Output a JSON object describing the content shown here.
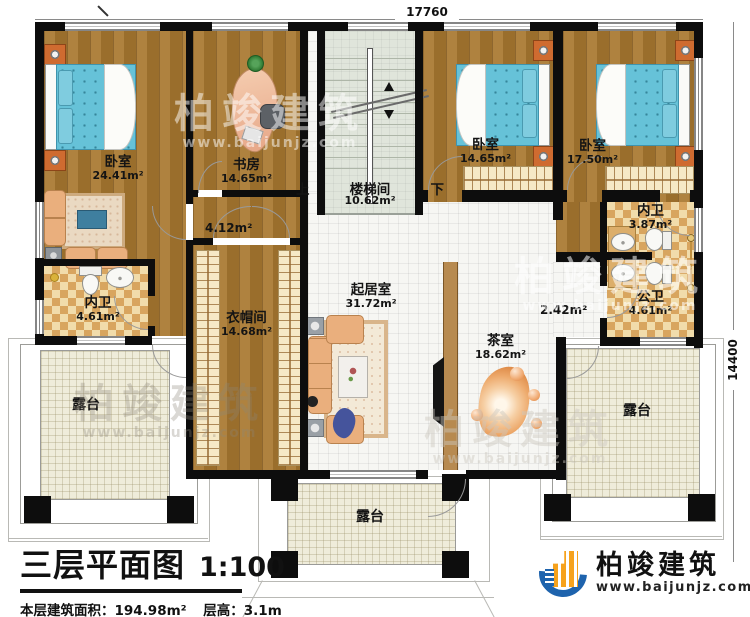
{
  "dims": {
    "top": "17760",
    "right": "14400"
  },
  "stairwell": {
    "up": "上",
    "name": "楼梯间",
    "down": "下",
    "area": "10.62m²"
  },
  "rooms": {
    "bedroom_left": {
      "name": "卧室",
      "area": "24.41m²"
    },
    "study": {
      "name": "书房",
      "area": "14.65m²"
    },
    "bedroom_mid": {
      "name": "卧室",
      "area": "14.65m²"
    },
    "bedroom_right": {
      "name": "卧室",
      "area": "17.50m²"
    },
    "ensuite_left": {
      "name": "内卫",
      "area": "4.61m²"
    },
    "ensuite_right": {
      "name": "内卫",
      "area": "3.87m²"
    },
    "public_bath": {
      "name": "公卫",
      "area": "4.61m²"
    },
    "hall_left": {
      "area": "4.12m²"
    },
    "hall_right": {
      "area": "2.42m²"
    },
    "cloakroom": {
      "name": "衣帽间",
      "area": "14.68m²"
    },
    "living": {
      "name": "起居室",
      "area": "31.72m²"
    },
    "tea": {
      "name": "茶室",
      "area": "18.62m²"
    },
    "terrace": {
      "name": "露台"
    }
  },
  "title_block": {
    "title": "三层平面图",
    "scale": "1:100",
    "floor_area": "本层建筑面积：194.98m²",
    "floor_height": "层高：3.1m"
  },
  "logo": {
    "company": "柏竣建筑",
    "website": "www.baijunjz.com"
  },
  "watermark": {
    "company": "柏竣建筑",
    "website": "www.baijunjz.com"
  }
}
